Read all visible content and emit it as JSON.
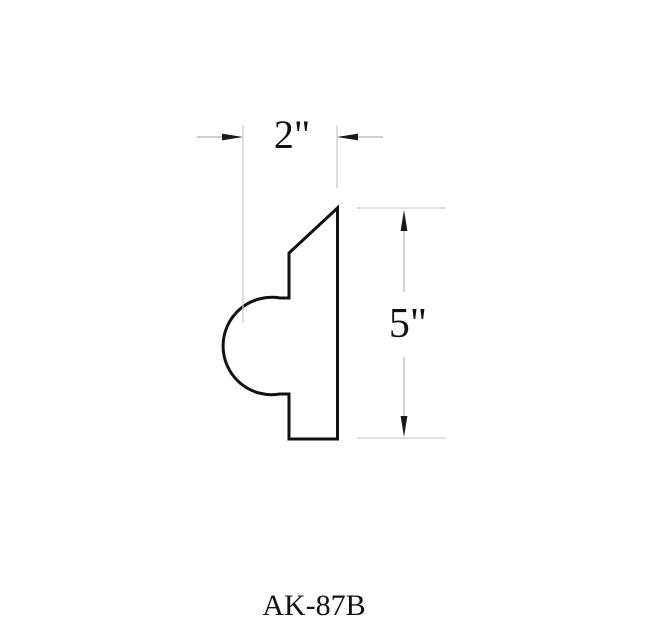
{
  "drawing": {
    "product_code": "AK-87B",
    "type_note": "molding profile cross-section line drawing",
    "profile_path": "M 337.5 208 L 337.5 439 L 289 439 L 289 394 L 280 394 A 48.7 48.7 0 1 1 280 298 L 289 298 L 289 253 Z",
    "dimensions": {
      "width": {
        "label": "2\"",
        "value_inches": 2
      },
      "height": {
        "label": "5\"",
        "value_inches": 5
      }
    },
    "colors": {
      "background": "#ffffff",
      "profile_stroke": "#111111",
      "dimension_line": "#b0b0b0",
      "extension_line": "#c9c9c9",
      "arrowhead": "#1a1a1a",
      "text": "#111111"
    }
  }
}
